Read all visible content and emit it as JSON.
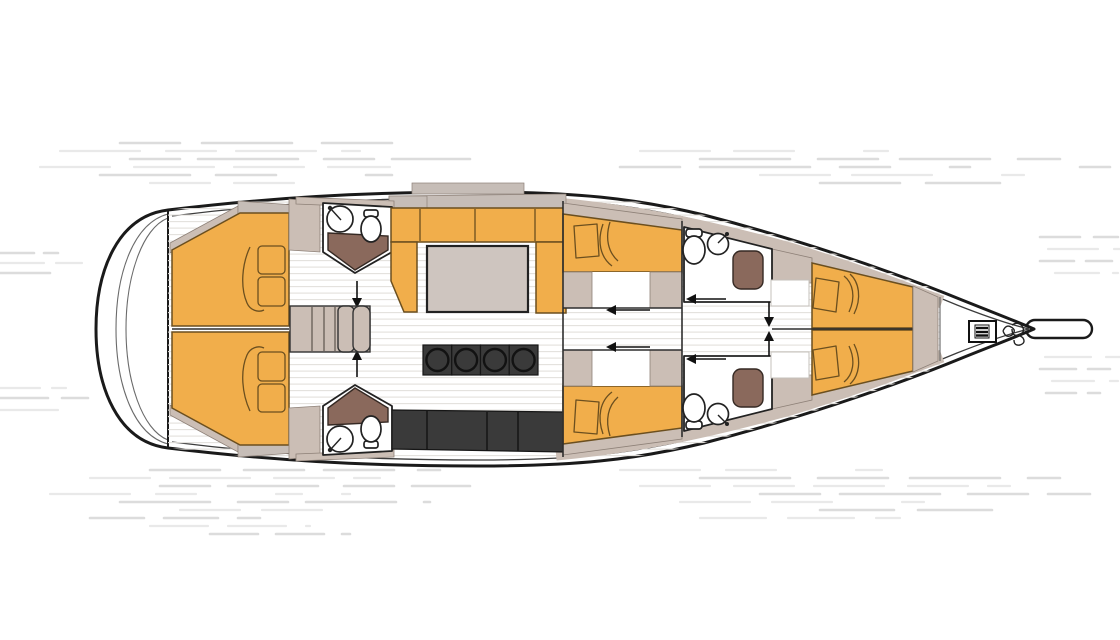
{
  "diagram": {
    "type": "yacht-interior-floor-plan",
    "orientation": "bow-right",
    "description": "Top-down deck plan of a sailing yacht interior with water streak background"
  },
  "colors": {
    "hull_line": "#1a1a1a",
    "upholstery_orange": "#f1ae4b",
    "wall_beige": "#cbbeb5",
    "deck_gray": "#c6bdb7",
    "shower_brown": "#8a695c",
    "counter_dark": "#3a3a3a",
    "table_top": "#cec5bf",
    "sketch_line": "#6b4f1f",
    "fixture_line": "#222222",
    "floor_plank_line": "#e3e0dc",
    "water_streak": "#dcdcdc",
    "background": "#ffffff"
  },
  "rooms": [
    "aft-cabin-port",
    "aft-cabin-starboard",
    "aft-head-port",
    "aft-head-starboard",
    "companionway-stairs",
    "salon",
    "galley",
    "mid-cabin-port",
    "mid-cabin-starboard",
    "forward-head-port",
    "forward-head-starboard",
    "v-berth",
    "anchor-locker"
  ],
  "fixtures": {
    "double_beds_aft": 2,
    "mid_cabin_beds": 2,
    "v_berth_beds": 2,
    "toilets": 4,
    "sinks": 4,
    "shower_seats": 4,
    "salon_settee": 1,
    "salon_table": 1,
    "galley_burners": 4,
    "companionway_steps": 5,
    "windlass": 1,
    "anchor_chain": 1,
    "bowsprit": 1
  }
}
